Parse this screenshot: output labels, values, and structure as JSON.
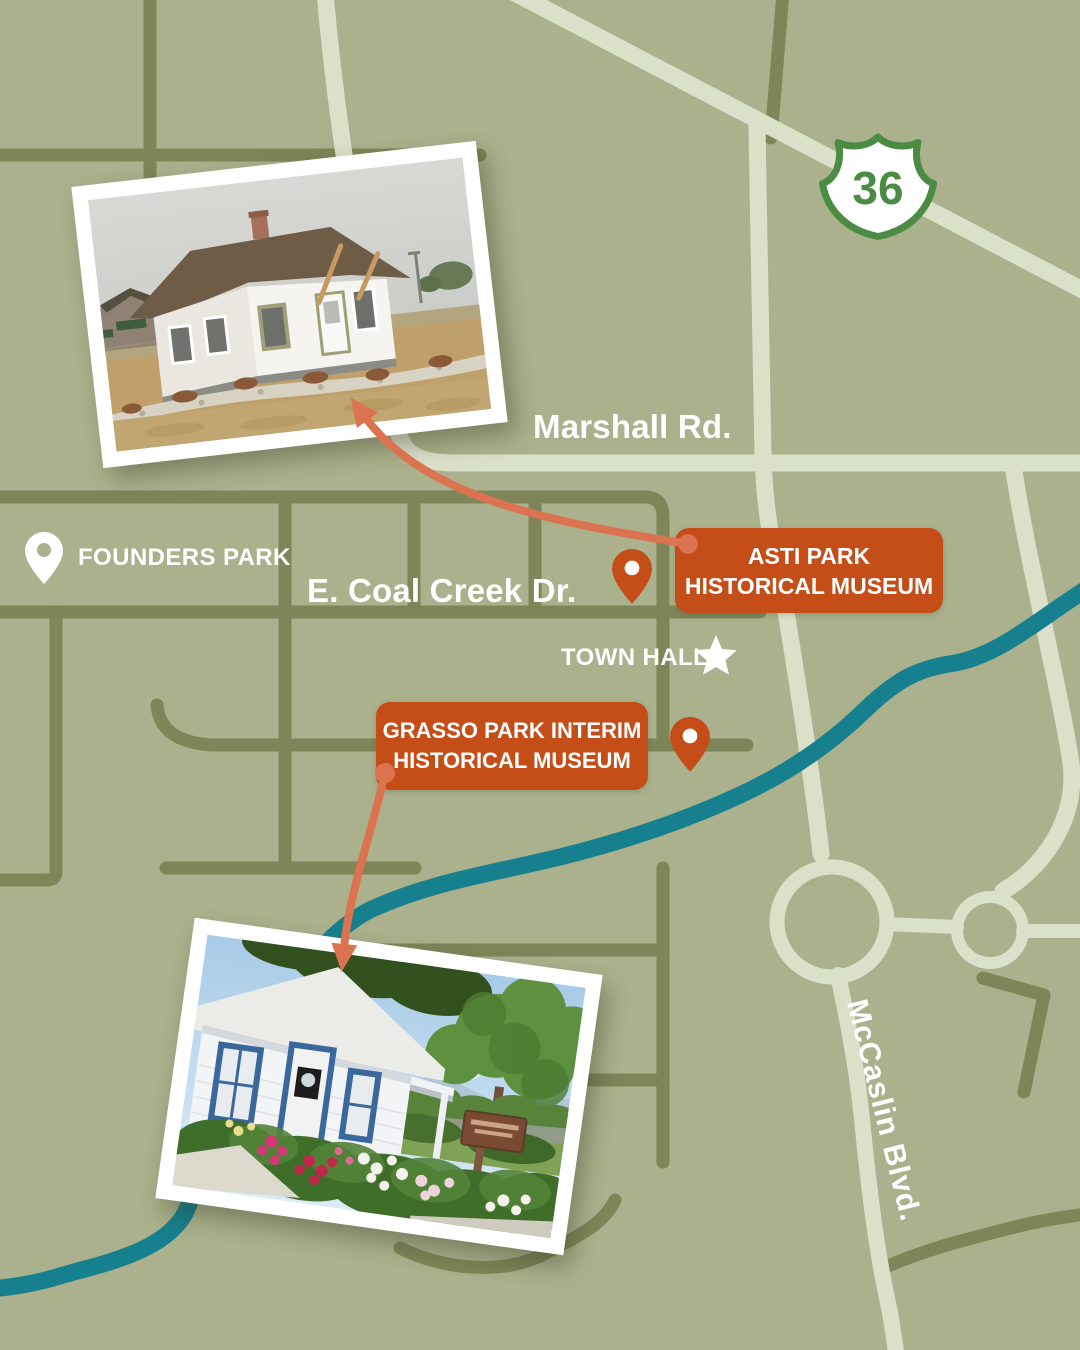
{
  "map": {
    "colors": {
      "background": "#aab18c",
      "road_dark": "#7e8558",
      "road_light": "#dbe0c9",
      "creek_teal": "#17808e",
      "shield_green": "#4c8b44",
      "badge_orange": "#c54d18",
      "arrow_orange": "#db7350",
      "label_white": "#ffffff"
    },
    "route_shield": {
      "number": "36"
    },
    "labels": {
      "marshall_rd": "Marshall Rd.",
      "coal_creek_dr": "E. Coal Creek Dr.",
      "mccaslin_blvd": "McCaslin Blvd.",
      "founders_park": "FOUNDERS PARK",
      "town_hall": "TOWN HALL"
    }
  },
  "markers": {
    "asti": {
      "line1": "ASTI PARK",
      "line2": "HISTORICAL MUSEUM"
    },
    "grasso": {
      "line1": "GRASSO PARK INTERIM",
      "line2": "HISTORICAL MUSEUM"
    }
  }
}
